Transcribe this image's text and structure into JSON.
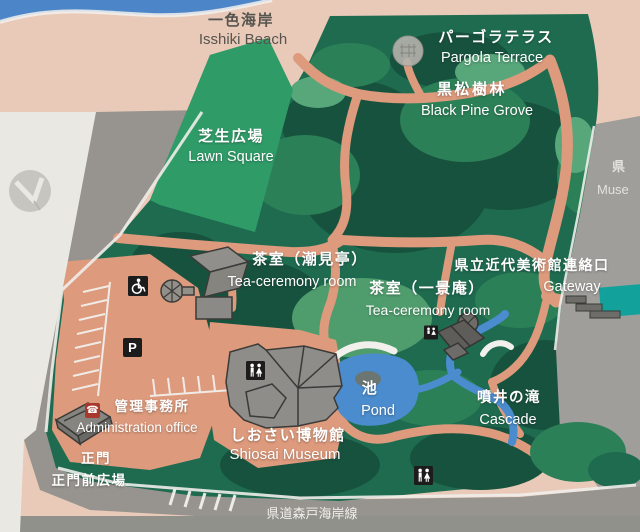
{
  "map": {
    "areas": {
      "isshiki_beach": {
        "ja": "一色海岸",
        "en": "Isshiki Beach"
      },
      "pargola_terrace": {
        "ja": "パーゴラテラス",
        "en": "Pargola Terrace"
      },
      "black_pine_grove": {
        "ja": "黒松樹林",
        "en": "Black Pine Grove"
      },
      "lawn_square": {
        "ja": "芝生広場",
        "en": "Lawn Square"
      },
      "tea_room_shiomitei": {
        "ja": "茶室（潮見亭）",
        "en": "Tea-ceremony room"
      },
      "museum_gateway": {
        "ja": "県立近代美術館連絡口",
        "en": "Gateway"
      },
      "tea_room_ikkeian": {
        "ja": "茶室（一景庵）",
        "en": "Tea-ceremony room"
      },
      "pond": {
        "ja": "池",
        "en": "Pond"
      },
      "cascade": {
        "ja": "噴井の滝",
        "en": "Cascade"
      },
      "admin_office": {
        "ja": "管理事務所",
        "en": "Administration office"
      },
      "main_gate": {
        "ja": "正門"
      },
      "main_gate_plaza": {
        "ja": "正門前広場"
      },
      "shiosai_museum": {
        "ja": "しおさい博物館",
        "en": "Shiosai Museum"
      },
      "prefectural_road": {
        "ja": "県道森戸海岸線"
      },
      "art_museum_partial": {
        "ja": "県",
        "en": "Muse"
      }
    },
    "icons": {
      "parking": {
        "glyph": "P"
      },
      "phone": {
        "glyph": "☎"
      }
    },
    "colors": {
      "park_green": "#1e6b50",
      "lawn_green": "#2f9c68",
      "path_salmon": "#dd9a7c",
      "water_blue": "#4a8ccd",
      "beach_sand": "#e9cab9",
      "road_grey": "#97948f",
      "panel_white": "#eae8e3",
      "museum_teal": "#12a19b",
      "sky_blue": "#4c86c8"
    }
  }
}
